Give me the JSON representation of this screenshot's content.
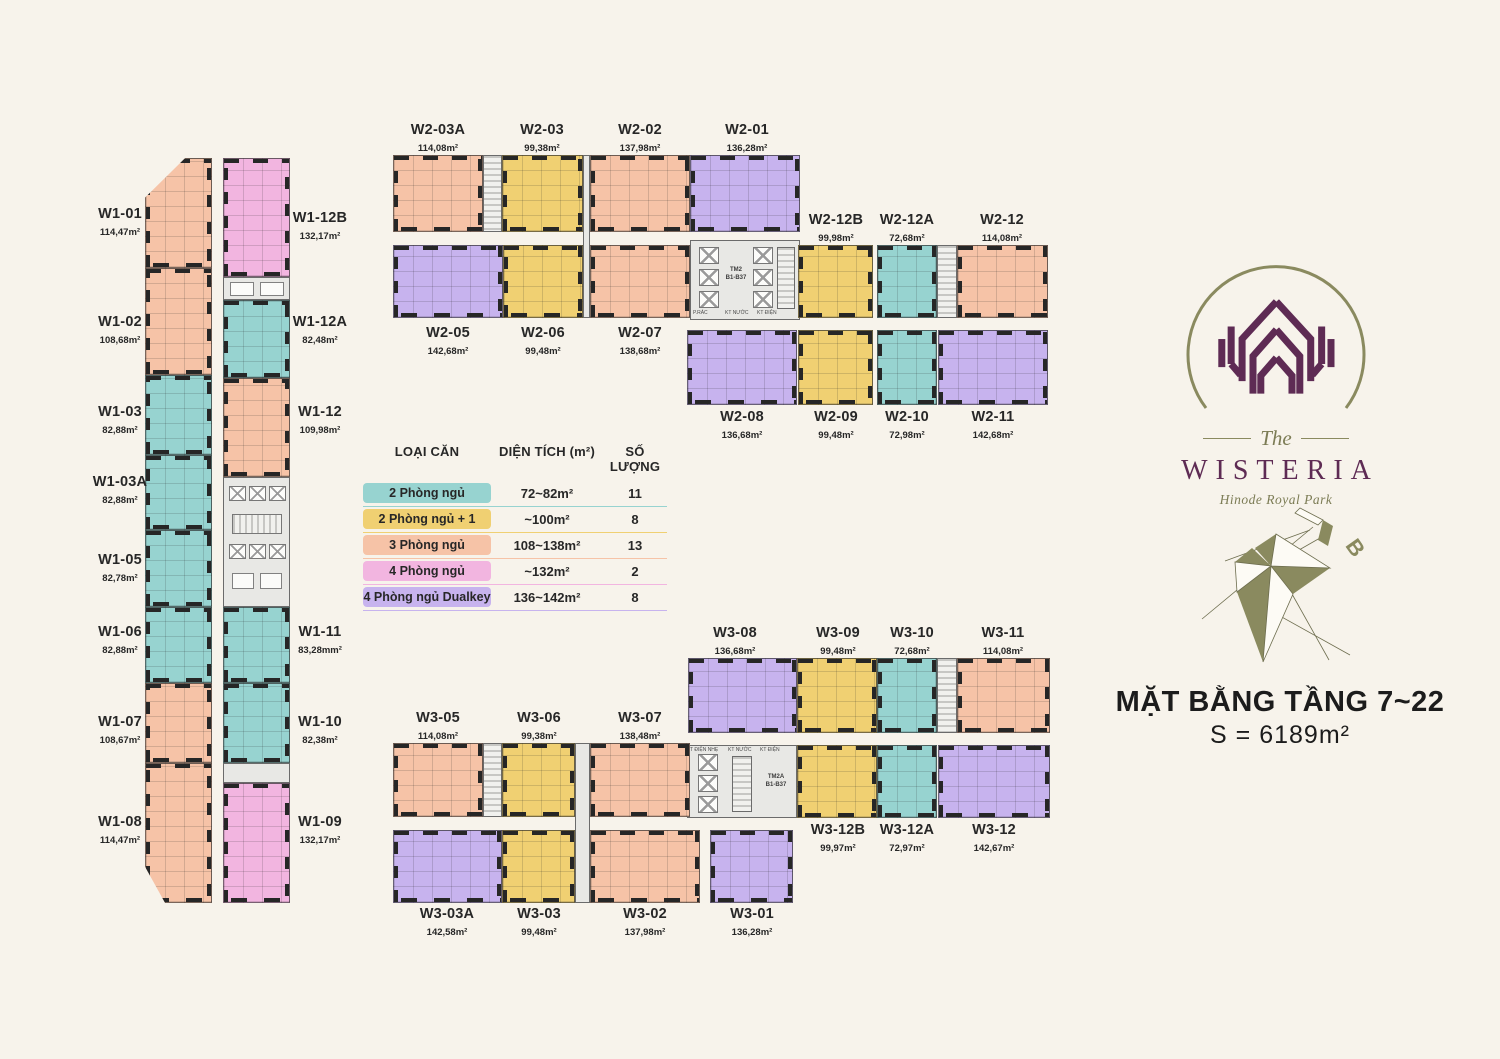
{
  "title": {
    "line1": "MẶT BẰNG TẦNG 7~22",
    "line2": "S = 6189m²"
  },
  "logo": {
    "the": "The",
    "name": "WISTERIA",
    "subtitle": "Hinode Royal Park"
  },
  "compass": {
    "label": "B"
  },
  "colors": {
    "background": "#f7f3eb",
    "2pn_teal": "#97d3d0",
    "2pn1_yellow": "#f0d072",
    "3pn_salmon": "#f6c3a7",
    "4pn_pink": "#f2b5e0",
    "4pn_dualkey_purple": "#c7b3ee",
    "logo_plum": "#5e2b54",
    "logo_olive": "#8a8a5f"
  },
  "legend": {
    "headers": [
      "LOẠI CĂN",
      "DIỆN TÍCH (m²)",
      "SỐ LƯỢNG"
    ],
    "rows": [
      {
        "label": "2 Phòng ngủ",
        "range": "72~82m²",
        "count": "11",
        "color": "#97d3d0"
      },
      {
        "label": "2 Phòng ngủ + 1",
        "range": "~100m²",
        "count": "8",
        "color": "#f0d072"
      },
      {
        "label": "3 Phòng ngủ",
        "range": "108~138m²",
        "count": "13",
        "color": "#f6c3a7"
      },
      {
        "label": "4 Phòng ngủ",
        "range": "~132m²",
        "count": "2",
        "color": "#f2b5e0"
      },
      {
        "label": "4 Phòng ngủ Dualkey",
        "range": "136~142m²",
        "count": "8",
        "color": "#c7b3ee"
      }
    ]
  },
  "cores": {
    "w2": {
      "line1": "TM2",
      "line2": "B1-B37",
      "small": [
        "P.RÁC",
        "KT NƯỚC",
        "KT ĐIỆN"
      ]
    },
    "w3": {
      "line1": "TM2A",
      "line2": "B1-B37",
      "small": [
        "T ĐIỆN NHẸ",
        "KT NƯỚC",
        "KT ĐIỆN"
      ]
    }
  },
  "units": {
    "w1_01": {
      "id": "W1-01",
      "area": "114,47m²",
      "type": "3 Phòng ngủ"
    },
    "w1_02": {
      "id": "W1-02",
      "area": "108,68m²",
      "type": "3 Phòng ngủ"
    },
    "w1_03": {
      "id": "W1-03",
      "area": "82,88m²",
      "type": "2 Phòng ngủ"
    },
    "w1_03a": {
      "id": "W1-03A",
      "area": "82,88m²",
      "type": "2 Phòng ngủ"
    },
    "w1_05": {
      "id": "W1-05",
      "area": "82,78m²",
      "type": "2 Phòng ngủ"
    },
    "w1_06": {
      "id": "W1-06",
      "area": "82,88m²",
      "type": "2 Phòng ngủ"
    },
    "w1_07": {
      "id": "W1-07",
      "area": "108,67m²",
      "type": "3 Phòng ngủ"
    },
    "w1_08": {
      "id": "W1-08",
      "area": "114,47m²",
      "type": "3 Phòng ngủ"
    },
    "w1_09": {
      "id": "W1-09",
      "area": "132,17m²",
      "type": "4 Phòng ngủ"
    },
    "w1_10": {
      "id": "W1-10",
      "area": "82,38m²",
      "type": "2 Phòng ngủ"
    },
    "w1_11": {
      "id": "W1-11",
      "area": "83,28mm²",
      "type": "2 Phòng ngủ"
    },
    "w1_12": {
      "id": "W1-12",
      "area": "109,98m²",
      "type": "3 Phòng ngủ"
    },
    "w1_12a": {
      "id": "W1-12A",
      "area": "82,48m²",
      "type": "2 Phòng ngủ"
    },
    "w1_12b": {
      "id": "W1-12B",
      "area": "132,17m²",
      "type": "4 Phòng ngủ"
    },
    "w2_01": {
      "id": "W2-01",
      "area": "136,28m²",
      "type": "4 Phòng ngủ Dualkey"
    },
    "w2_02": {
      "id": "W2-02",
      "area": "137,98m²",
      "type": "3 Phòng ngủ"
    },
    "w2_03": {
      "id": "W2-03",
      "area": "99,38m²",
      "type": "2 Phòng ngủ + 1"
    },
    "w2_03a": {
      "id": "W2-03A",
      "area": "114,08m²",
      "type": "3 Phòng ngủ"
    },
    "w2_05": {
      "id": "W2-05",
      "area": "142,68m²",
      "type": "4 Phòng ngủ Dualkey"
    },
    "w2_06": {
      "id": "W2-06",
      "area": "99,48m²",
      "type": "2 Phòng ngủ + 1"
    },
    "w2_07": {
      "id": "W2-07",
      "area": "138,68m²",
      "type": "3 Phòng ngủ"
    },
    "w2_08": {
      "id": "W2-08",
      "area": "136,68m²",
      "type": "4 Phòng ngủ Dualkey"
    },
    "w2_09": {
      "id": "W2-09",
      "area": "99,48m²",
      "type": "2 Phòng ngủ + 1"
    },
    "w2_10": {
      "id": "W2-10",
      "area": "72,98m²",
      "type": "2 Phòng ngủ"
    },
    "w2_11": {
      "id": "W2-11",
      "area": "142,68m²",
      "type": "4 Phòng ngủ Dualkey"
    },
    "w2_12": {
      "id": "W2-12",
      "area": "114,08m²",
      "type": "3 Phòng ngủ"
    },
    "w2_12a": {
      "id": "W2-12A",
      "area": "72,68m²",
      "type": "2 Phòng ngủ"
    },
    "w2_12b": {
      "id": "W2-12B",
      "area": "99,98m²",
      "type": "2 Phòng ngủ + 1"
    },
    "w3_01": {
      "id": "W3-01",
      "area": "136,28m²",
      "type": "4 Phòng ngủ Dualkey"
    },
    "w3_02": {
      "id": "W3-02",
      "area": "137,98m²",
      "type": "3 Phòng ngủ"
    },
    "w3_03": {
      "id": "W3-03",
      "area": "99,48m²",
      "type": "2 Phòng ngủ + 1"
    },
    "w3_03a": {
      "id": "W3-03A",
      "area": "142,58m²",
      "type": "4 Phòng ngủ Dualkey"
    },
    "w3_05": {
      "id": "W3-05",
      "area": "114,08m²",
      "type": "3 Phòng ngủ"
    },
    "w3_06": {
      "id": "W3-06",
      "area": "99,38m²",
      "type": "2 Phòng ngủ + 1"
    },
    "w3_07": {
      "id": "W3-07",
      "area": "138,48m²",
      "type": "3 Phòng ngủ"
    },
    "w3_08": {
      "id": "W3-08",
      "area": "136,68m²",
      "type": "4 Phòng ngủ Dualkey"
    },
    "w3_09": {
      "id": "W3-09",
      "area": "99,48m²",
      "type": "2 Phòng ngủ + 1"
    },
    "w3_10": {
      "id": "W3-10",
      "area": "72,68m²",
      "type": "2 Phòng ngủ"
    },
    "w3_11": {
      "id": "W3-11",
      "area": "114,08m²",
      "type": "3 Phòng ngủ"
    },
    "w3_12": {
      "id": "W3-12",
      "area": "142,67m²",
      "type": "4 Phòng ngủ Dualkey"
    },
    "w3_12a": {
      "id": "W3-12A",
      "area": "72,97m²",
      "type": "2 Phòng ngủ"
    },
    "w3_12b": {
      "id": "W3-12B",
      "area": "99,97m²",
      "type": "2 Phòng ngủ + 1"
    }
  }
}
